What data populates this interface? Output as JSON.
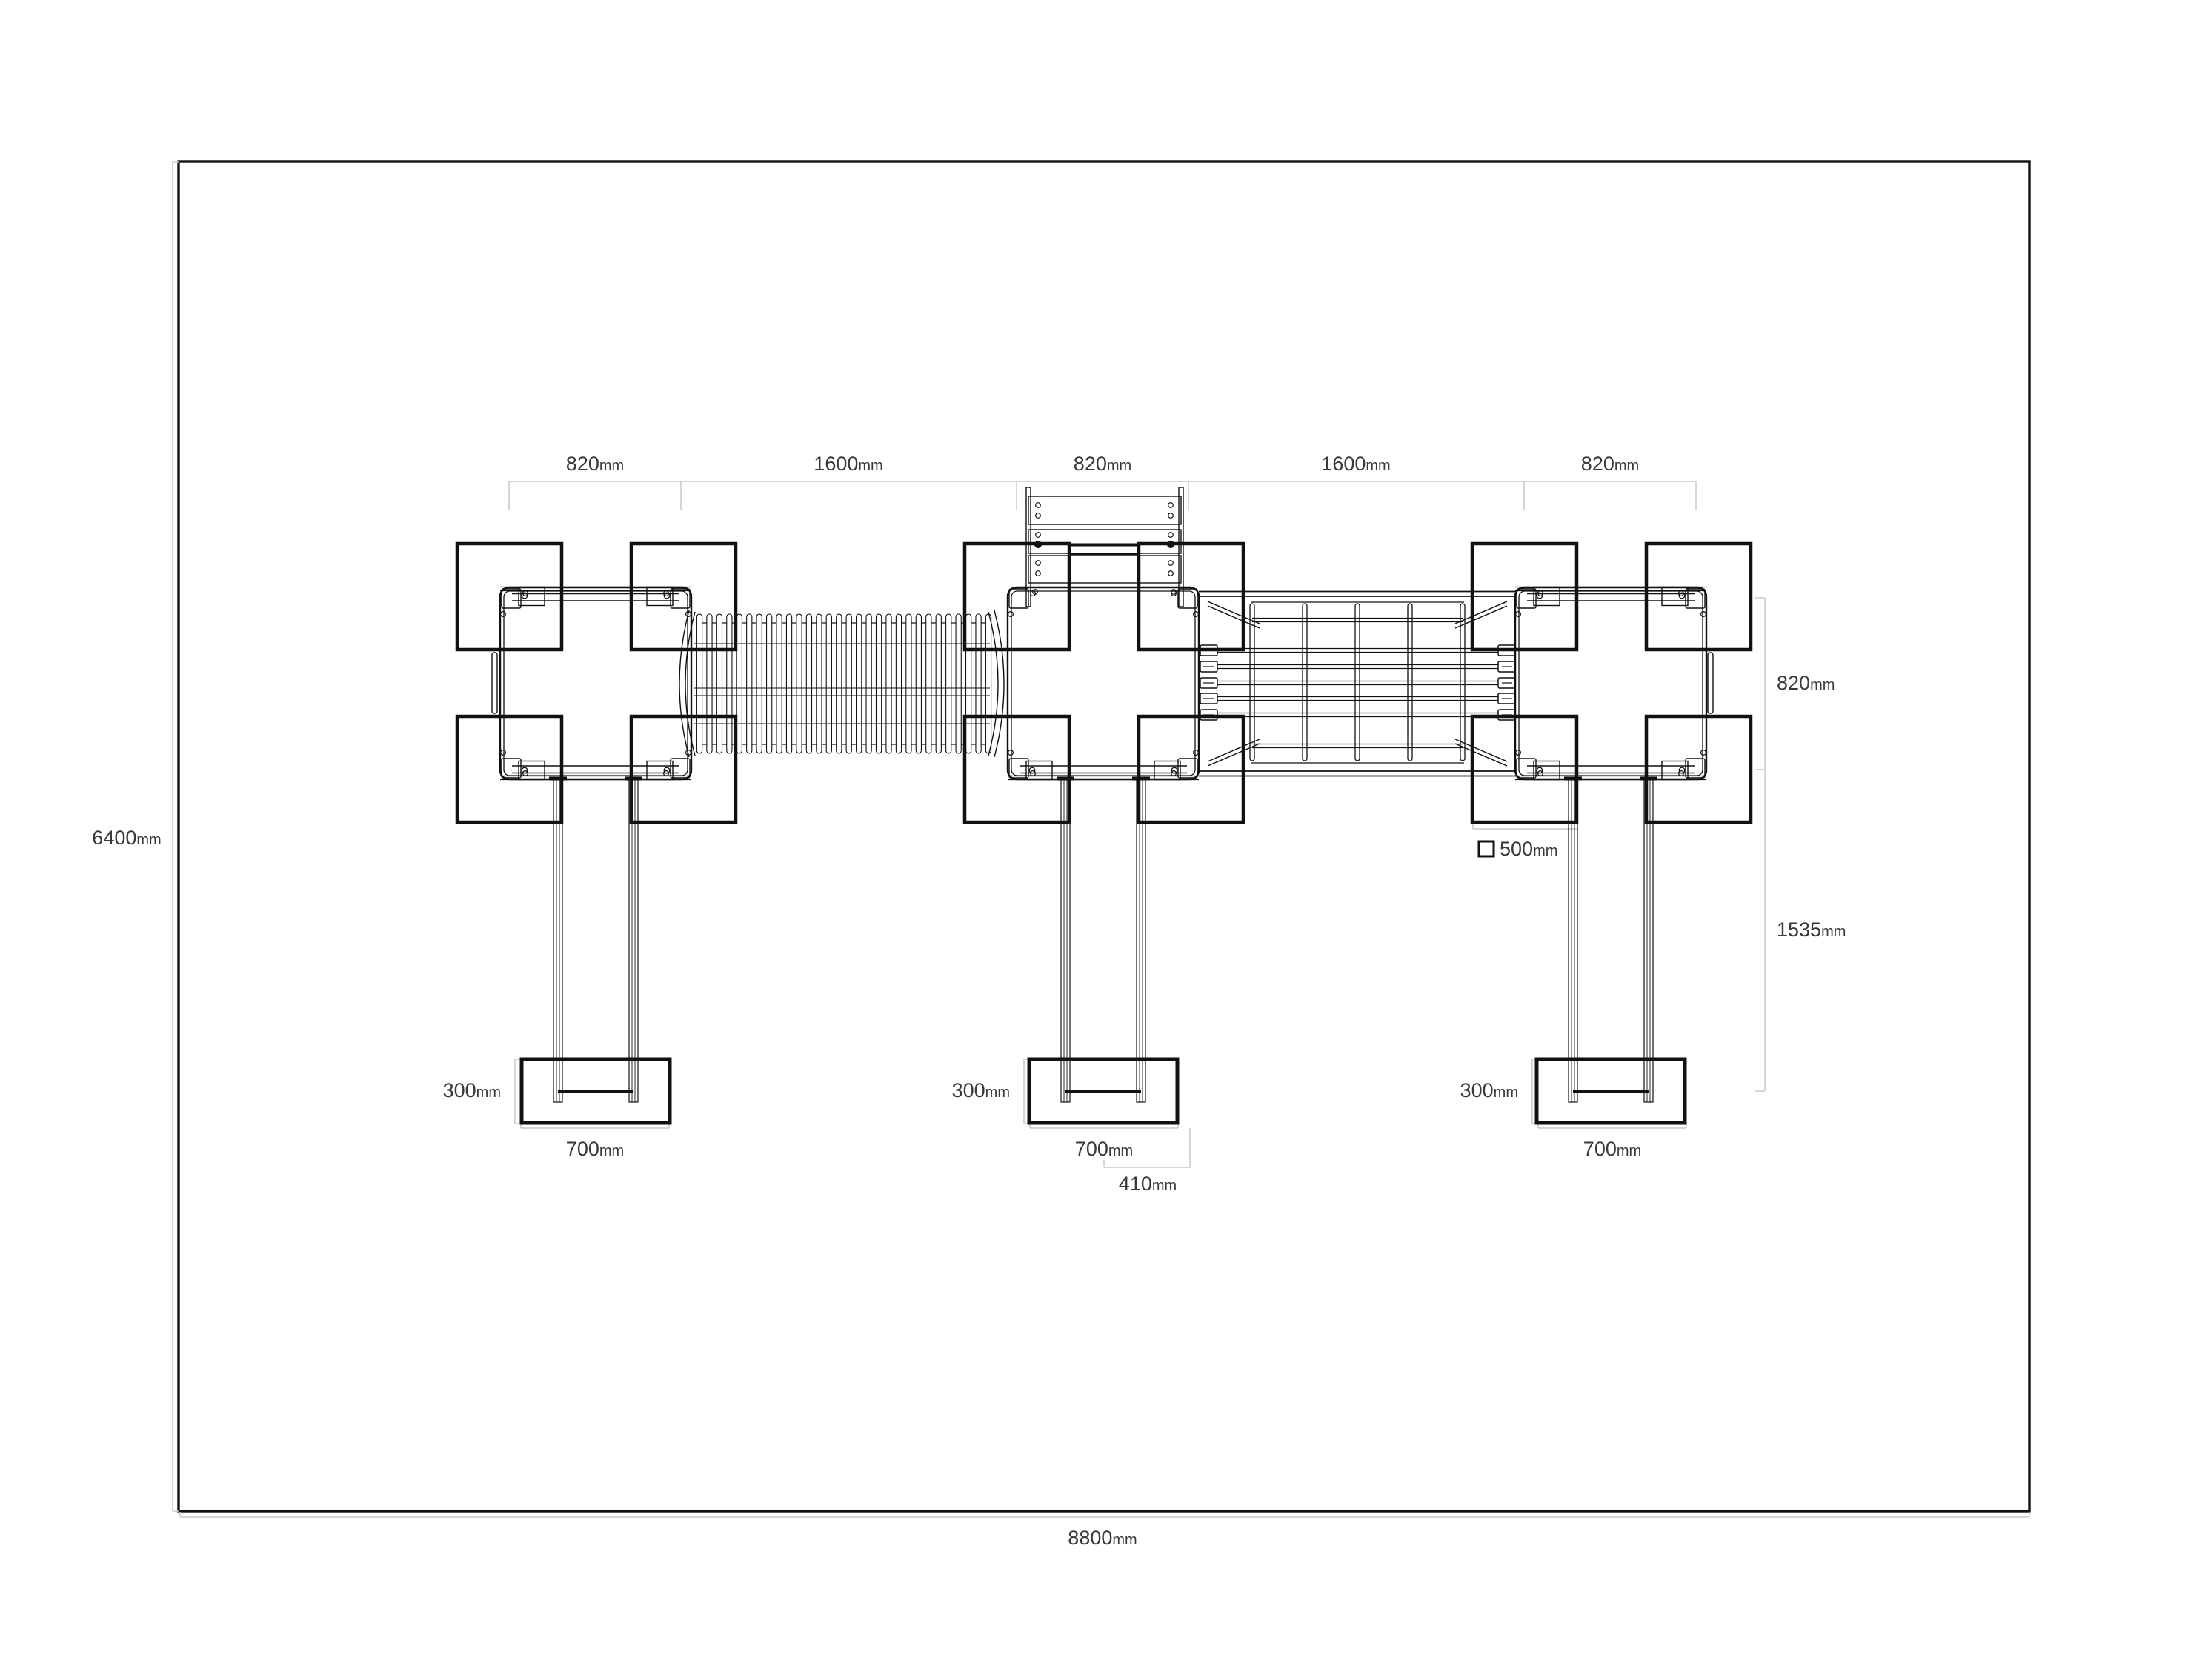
{
  "document": {
    "type": "technical plan drawing",
    "subject": "playground climbing structure plan view with tunnel bridge, net bridge, ladder, ground pads and concrete footings"
  },
  "colors": {
    "background": "#ffffff",
    "structure_line": "#111111",
    "dimension_line": "#c8c8c8",
    "label_text": "#37393b"
  },
  "labels": {
    "top_spans": [
      {
        "value": "820",
        "unit": "mm"
      },
      {
        "value": "1600",
        "unit": "mm"
      },
      {
        "value": "820",
        "unit": "mm"
      },
      {
        "value": "1600",
        "unit": "mm"
      },
      {
        "value": "820",
        "unit": "mm"
      }
    ],
    "overall_height": {
      "value": "6400",
      "unit": "mm"
    },
    "overall_width": {
      "value": "8800",
      "unit": "mm"
    },
    "right_side": {
      "platform_depth": {
        "value": "820",
        "unit": "mm"
      },
      "leg_depth": {
        "value": "1535",
        "unit": "mm"
      }
    },
    "pad_legend": {
      "value": "500",
      "unit": "mm"
    },
    "footing": {
      "depth": {
        "value": "300",
        "unit": "mm"
      },
      "width": {
        "value": "700",
        "unit": "mm"
      },
      "offset": {
        "value": "410",
        "unit": "mm"
      }
    }
  }
}
